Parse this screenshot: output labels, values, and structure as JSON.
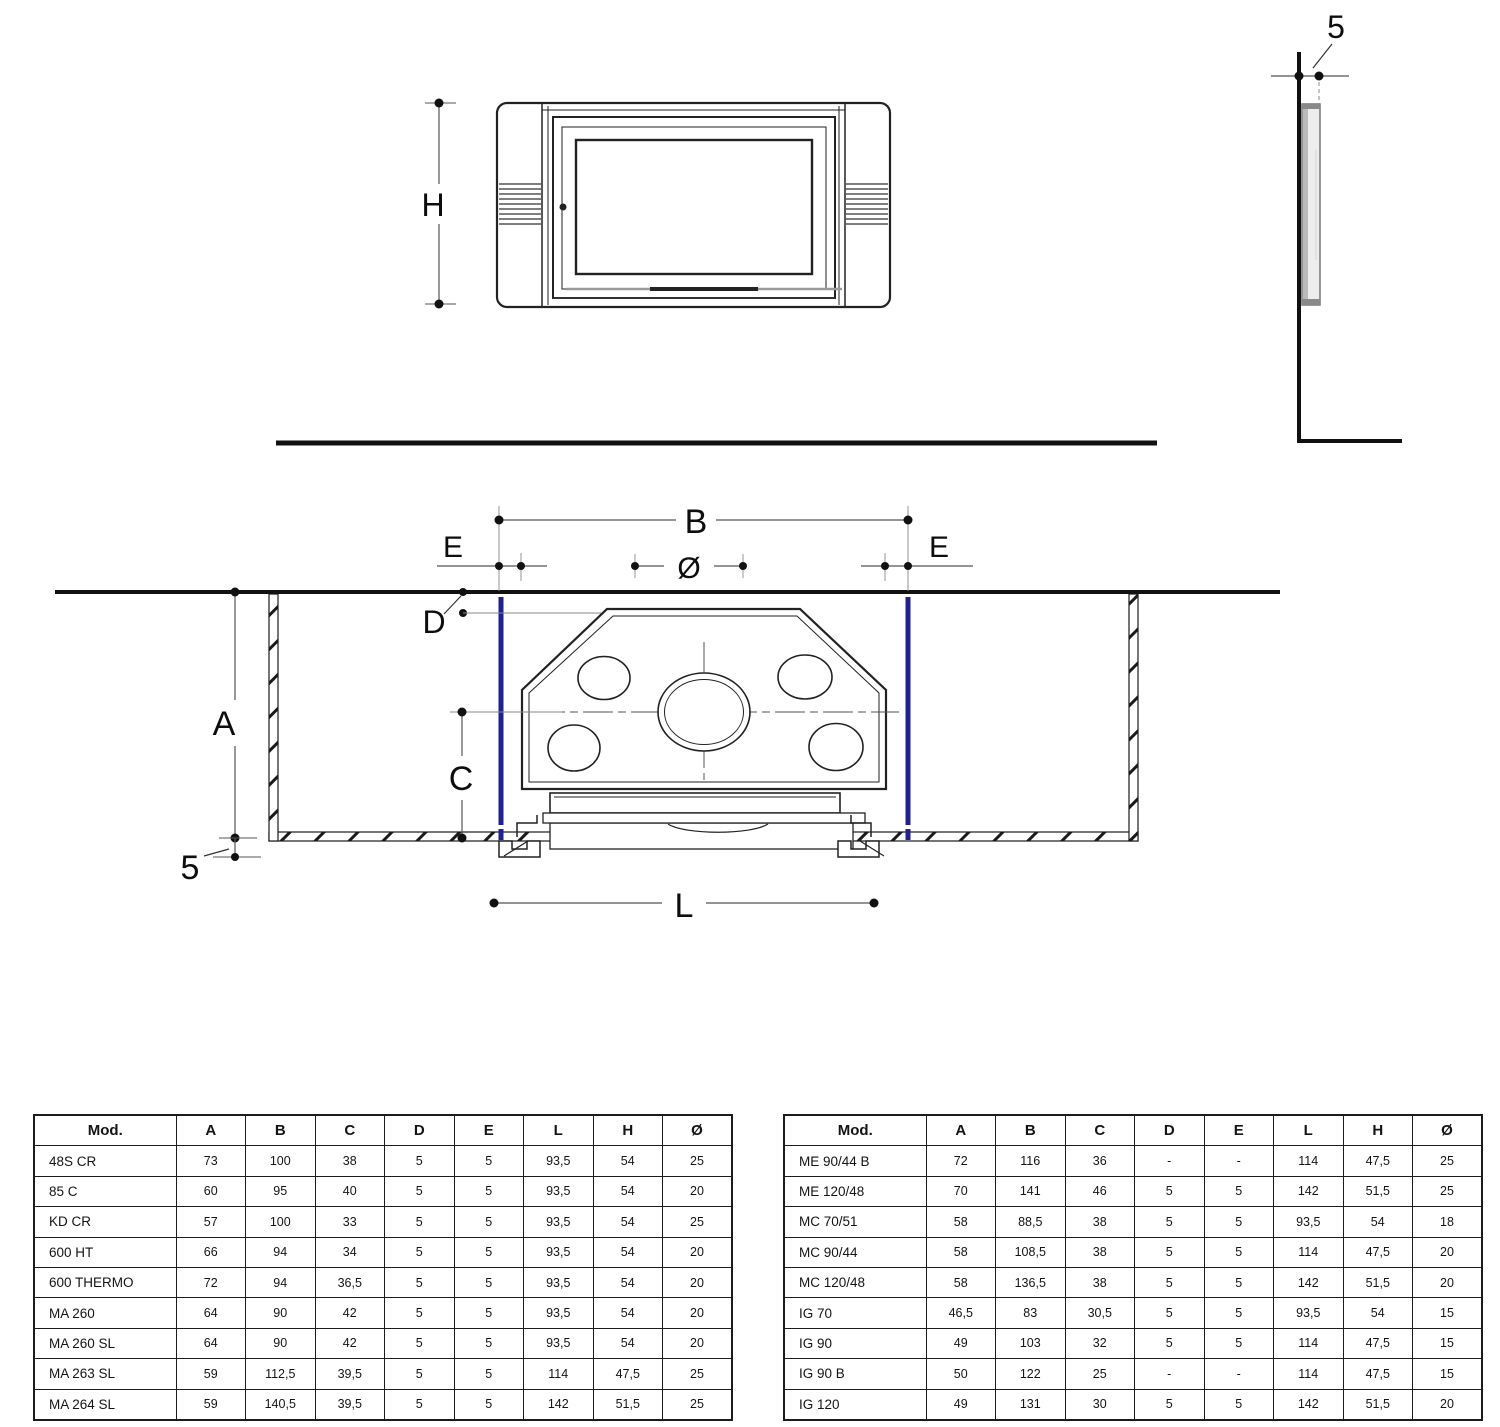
{
  "diagram": {
    "labels": {
      "h": "H",
      "five_side": "5",
      "b": "B",
      "e_left": "E",
      "e_right": "E",
      "diameter": "Ø",
      "d": "D",
      "a": "A",
      "c": "C",
      "five_plan": "5",
      "l": "L"
    },
    "colors": {
      "accent_blue": "#20208f",
      "line_dark": "#1a1a1a"
    }
  },
  "tables": {
    "columns": [
      "Mod.",
      "A",
      "B",
      "C",
      "D",
      "E",
      "L",
      "H",
      "Ø"
    ],
    "left": {
      "rows": [
        [
          "48S CR",
          "73",
          "100",
          "38",
          "5",
          "5",
          "93,5",
          "54",
          "25"
        ],
        [
          "85 C",
          "60",
          "95",
          "40",
          "5",
          "5",
          "93,5",
          "54",
          "20"
        ],
        [
          "KD CR",
          "57",
          "100",
          "33",
          "5",
          "5",
          "93,5",
          "54",
          "25"
        ],
        [
          "600 HT",
          "66",
          "94",
          "34",
          "5",
          "5",
          "93,5",
          "54",
          "20"
        ],
        [
          "600 THERMO",
          "72",
          "94",
          "36,5",
          "5",
          "5",
          "93,5",
          "54",
          "20"
        ],
        [
          "MA 260",
          "64",
          "90",
          "42",
          "5",
          "5",
          "93,5",
          "54",
          "20"
        ],
        [
          "MA 260 SL",
          "64",
          "90",
          "42",
          "5",
          "5",
          "93,5",
          "54",
          "20"
        ],
        [
          "MA 263 SL",
          "59",
          "112,5",
          "39,5",
          "5",
          "5",
          "114",
          "47,5",
          "25"
        ],
        [
          "MA 264 SL",
          "59",
          "140,5",
          "39,5",
          "5",
          "5",
          "142",
          "51,5",
          "25"
        ]
      ]
    },
    "right": {
      "rows": [
        [
          "ME 90/44 B",
          "72",
          "116",
          "36",
          "-",
          "-",
          "114",
          "47,5",
          "25"
        ],
        [
          "ME 120/48",
          "70",
          "141",
          "46",
          "5",
          "5",
          "142",
          "51,5",
          "25"
        ],
        [
          "MC 70/51",
          "58",
          "88,5",
          "38",
          "5",
          "5",
          "93,5",
          "54",
          "18"
        ],
        [
          "MC 90/44",
          "58",
          "108,5",
          "38",
          "5",
          "5",
          "114",
          "47,5",
          "20"
        ],
        [
          "MC 120/48",
          "58",
          "136,5",
          "38",
          "5",
          "5",
          "142",
          "51,5",
          "20"
        ],
        [
          "IG 70",
          "46,5",
          "83",
          "30,5",
          "5",
          "5",
          "93,5",
          "54",
          "15"
        ],
        [
          "IG 90",
          "49",
          "103",
          "32",
          "5",
          "5",
          "114",
          "47,5",
          "15"
        ],
        [
          "IG 90 B",
          "50",
          "122",
          "25",
          "-",
          "-",
          "114",
          "47,5",
          "15"
        ],
        [
          "IG 120",
          "49",
          "131",
          "30",
          "5",
          "5",
          "142",
          "51,5",
          "20"
        ]
      ]
    }
  }
}
